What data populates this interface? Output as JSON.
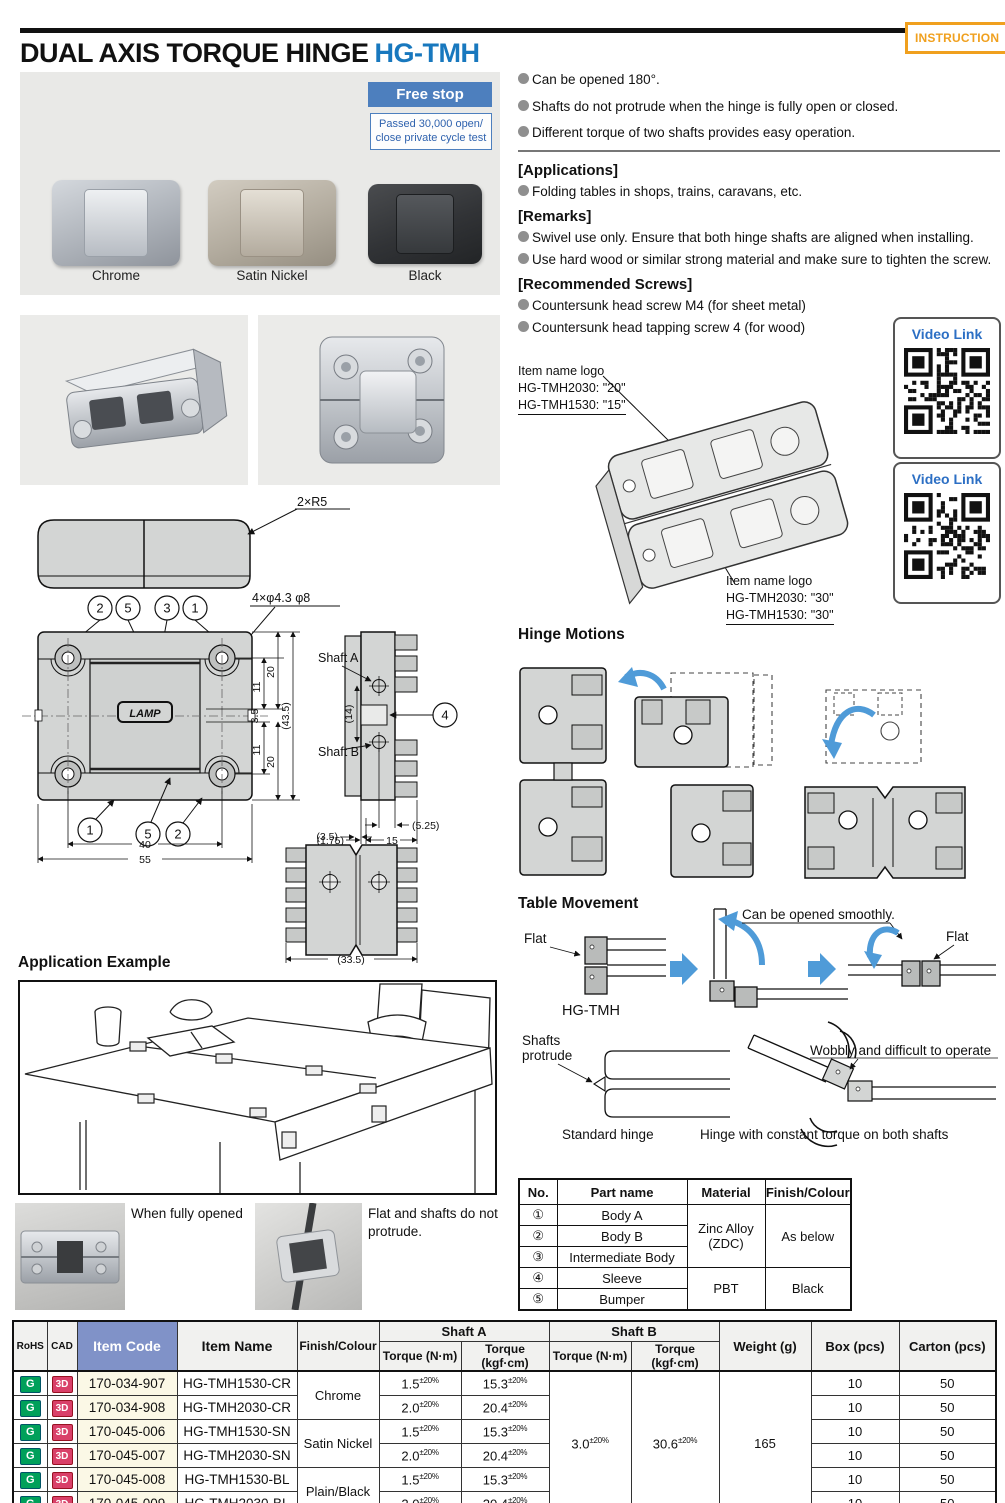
{
  "header": {
    "title": "DUAL AXIS TORQUE HINGE",
    "product_code": "HG-TMH",
    "instruction_badge": "INSTRUCTION"
  },
  "hero": {
    "free_stop_badge": "Free stop",
    "cycle_test_note": "Passed 30,000 open/ close private cycle test",
    "finish_labels": [
      "Chrome",
      "Satin Nickel",
      "Black"
    ]
  },
  "features": [
    "Can be opened 180°.",
    "Shafts do not protrude when the hinge is fully open or closed.",
    "Different torque of two shafts provides easy operation."
  ],
  "sections": {
    "applications": {
      "heading": "[Applications]",
      "items": [
        "Folding tables in shops, trains, caravans, etc."
      ]
    },
    "remarks": {
      "heading": "[Remarks]",
      "items": [
        "Swivel use only. Ensure that both hinge shafts are aligned when installing.",
        "Use hard wood or similar strong material and make sure to tighten the screw."
      ]
    },
    "screws": {
      "heading": "[Recommended Screws]",
      "items": [
        "Countersunk head screw M4 (for sheet metal)",
        "Countersunk head tapping screw 4 (for wood)"
      ]
    }
  },
  "video": {
    "label": "Video Link"
  },
  "iso_annotations": {
    "top": {
      "l1": "Item name logo",
      "l2": "HG-TMH2030: \"20\"",
      "l3": "HG-TMH1530: \"15\""
    },
    "bottom": {
      "l1": "Item name logo",
      "l2": "HG-TMH2030: \"30\"",
      "l3": "HG-TMH1530: \"30\""
    }
  },
  "drawing": {
    "r5": "2×R5",
    "holes": "4×φ4.3 φ8",
    "lamp": "LAMP",
    "shaft_a": "Shaft A",
    "shaft_b": "Shaft B",
    "c1": "1",
    "c2": "2",
    "c3": "3",
    "c4": "4",
    "c5": "5",
    "d20": "20",
    "d11": "11",
    "d3_5": "3.5",
    "d43_5": "(43.5)",
    "d14": "(14)",
    "d40": "40",
    "d55": "55",
    "d5_25": "(5.25)",
    "d1_75": "(1.75)",
    "d15": "15",
    "d3_5b": "(3.5)",
    "d33_5": "(33.5)"
  },
  "hinge_motions": {
    "heading": "Hinge Motions"
  },
  "table_movement": {
    "heading": "Table Movement",
    "flat": "Flat",
    "product": "HG-TMH",
    "smooth": "Can be opened smoothly.",
    "shafts_1": "Shafts",
    "shafts_2": "protrude",
    "standard": "Standard hinge",
    "wobbly": "Wobbly and difficult to operate",
    "constant": "Hinge with constant torque on both shafts"
  },
  "application_example": {
    "heading": "Application Example"
  },
  "captions": {
    "fully_opened": "When fully opened",
    "flat_no_protrude": "Flat and shafts do not protrude."
  },
  "parts_table": {
    "headers": [
      "No.",
      "Part name",
      "Material",
      "Finish/Colour"
    ],
    "rows": [
      {
        "no": "①",
        "name": "Body A"
      },
      {
        "no": "②",
        "name": "Body B"
      },
      {
        "no": "③",
        "name": "Intermediate Body"
      },
      {
        "no": "④",
        "name": "Sleeve"
      },
      {
        "no": "⑤",
        "name": "Bumper"
      }
    ],
    "material_metal": "Zinc Alloy (ZDC)",
    "material_plastic": "PBT",
    "finish_metal": "As below",
    "finish_plastic": "Black"
  },
  "spec_table": {
    "h": {
      "rohs": "RoHS",
      "cad": "CAD",
      "item_code": "Item Code",
      "item_name": "Item Name",
      "finish": "Finish/Colour",
      "shaft_a": "Shaft A",
      "shaft_b": "Shaft B",
      "nm": "Torque (N·m)",
      "kgf": "Torque (kgf·cm)",
      "weight": "Weight (g)",
      "box": "Box (pcs)",
      "carton": "Carton (pcs)"
    },
    "rohs_icon": "G",
    "cad_icon": "3D",
    "tol": "±20%",
    "rows": [
      {
        "code": "170-034-907",
        "name": "HG-TMH1530-CR",
        "nm": "1.5",
        "kgf": "15.3",
        "box": "10",
        "carton": "50"
      },
      {
        "code": "170-034-908",
        "name": "HG-TMH2030-CR",
        "nm": "2.0",
        "kgf": "20.4",
        "box": "10",
        "carton": "50"
      },
      {
        "code": "170-045-006",
        "name": "HG-TMH1530-SN",
        "nm": "1.5",
        "kgf": "15.3",
        "box": "10",
        "carton": "50"
      },
      {
        "code": "170-045-007",
        "name": "HG-TMH2030-SN",
        "nm": "2.0",
        "kgf": "20.4",
        "box": "10",
        "carton": "50"
      },
      {
        "code": "170-045-008",
        "name": "HG-TMH1530-BL",
        "nm": "1.5",
        "kgf": "15.3",
        "box": "10",
        "carton": "50"
      },
      {
        "code": "170-045-009",
        "name": "HG-TMH2030-BL",
        "nm": "2.0",
        "kgf": "20.4",
        "box": "10",
        "carton": "50"
      }
    ],
    "finish_groups": [
      "Chrome",
      "Satin Nickel",
      "Plain/Black"
    ],
    "shaft_b_nm": "3.0",
    "shaft_b_kgf": "30.6",
    "weight": "165"
  },
  "colors": {
    "accent_blue": "#1878be",
    "banner_blue": "#4d7fbe",
    "instruction_orange": "#f0a01e",
    "rohs_green": "#00a05a",
    "cad_pink": "#d94069",
    "item_code_header": "#8092c8",
    "item_code_cell": "#fbf8e6",
    "motion_arrow_blue": "#4f9bd8"
  }
}
